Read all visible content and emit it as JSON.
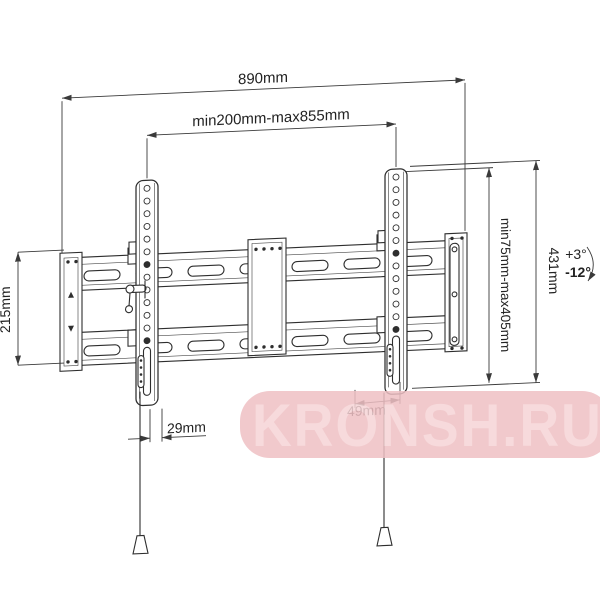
{
  "drawing": {
    "description": "Tilting TV wall mount bracket technical drawing",
    "line_color": "#2e2e2e"
  },
  "dims": {
    "total_width": "890mm",
    "width_range": "min200mm-max855mm",
    "left_height": "215mm",
    "right_height": "431mm",
    "height_range": "min75mm-max405mm",
    "bottom_left_offset": "29mm",
    "bottom_right_offset": "49mm",
    "tilt_up": "+3°",
    "tilt_down": "-12°"
  },
  "watermark": {
    "text": "KRONSH.RU",
    "band_color": "#efc0c4",
    "text_color": "#f6d4d6"
  }
}
